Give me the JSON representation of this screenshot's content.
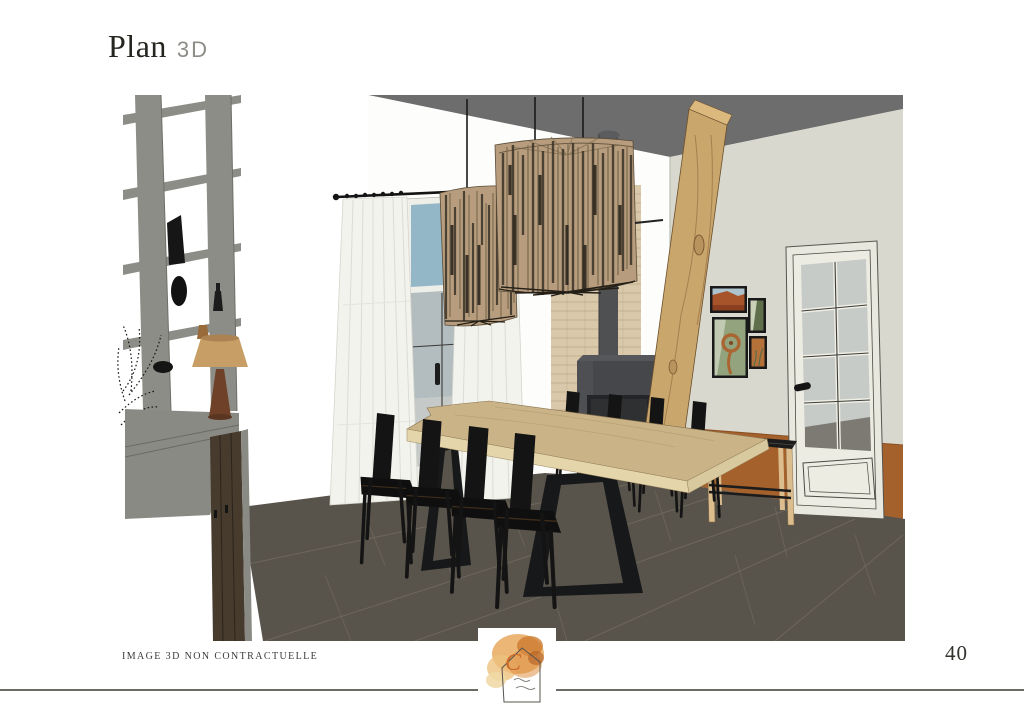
{
  "header": {
    "title": "Plan",
    "subtitle": "3D"
  },
  "footer": {
    "disclaimer": "IMAGE 3D NON CONTRACTUELLE",
    "page_number": "40",
    "logo": {
      "monogram": "C"
    }
  },
  "render": {
    "description": "3D interior rendering of a dining room",
    "items": [
      "open shelving unit with decorative objects and fern plant",
      "gray sideboard with dark wood doors",
      "table lamp with conical shade",
      "two woven rattan drum pendant lights",
      "white curtain panels on black rod",
      "glazed door with blue sky above",
      "exposed brick chimney column",
      "black log stove with flue pipe",
      "slanted structural wood beam",
      "live-edge wood dining table with black trapezoid legs",
      "eight black dining chairs",
      "gallery wall of four framed prints",
      "slatted bench with wood legs",
      "white French door with eight glass panes",
      "terracotta lower wall band",
      "dark stone tile floor"
    ],
    "palette": {
      "ceiling": "#6d6d6d",
      "wall_right": "#d8d8cf",
      "wall_back": "#fdfdfb",
      "wainscot_terracotta": "#a5612c",
      "floor_tile": "#59544b",
      "curtain": "#f3f3ee",
      "sky": "#93b7c6",
      "rattan_pendant": "#b79d7e",
      "wood_beam": "#c9a66c",
      "wood_table": "#c9b387",
      "brick": "#d9c8aa",
      "stove": "#45474a",
      "flame": "#e8882f",
      "chair_black": "#141414",
      "door": "#e9e8de",
      "bench_wood": "#dcbd8e",
      "shelf_gray": "#8d8d87",
      "sideboard_wood": "#473b2e",
      "lamp_shade": "#c79e66",
      "lamp_base": "#6e4128"
    }
  }
}
